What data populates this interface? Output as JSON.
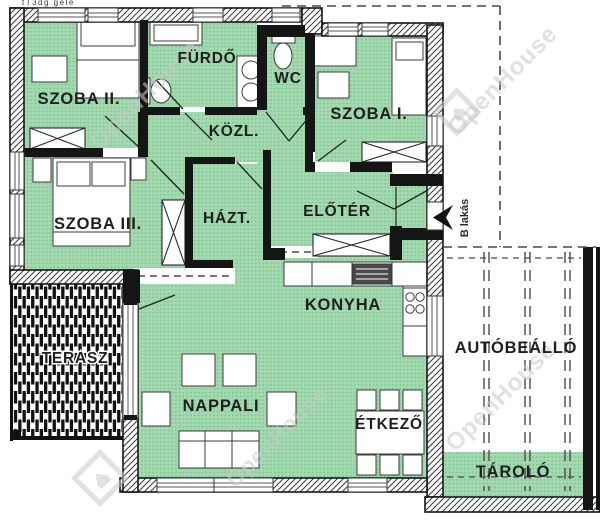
{
  "rooms": {
    "szoba2": "SZOBA II.",
    "furdo": "FÜRDŐ",
    "wc": "WC",
    "szoba1": "SZOBA I.",
    "kozl": "KÖZL.",
    "szoba3": "SZOBA III.",
    "hazt": "HÁZT.",
    "eloter": "ELŐTÉR",
    "konyha": "KONYHA",
    "terasz": "TERASZ",
    "nappali": "NAPPALI",
    "etkezo": "ÉTKEZŐ",
    "autobeallo": "AUTÓBEÁLLÓ",
    "tarolo": "TÁROLÓ"
  },
  "annotations": {
    "b_lakas": "B lakás",
    "corner_fragment": "tT3dg gele"
  },
  "watermark": {
    "text": "OpenHouse"
  },
  "colors": {
    "room_fill": "#a4d9b0",
    "room_dot": "#6fbe8b",
    "wall": "#151515",
    "hatch_line": "#3a3a3a",
    "dash_line": "#4a4a4a",
    "label": "#1f1f1f",
    "watermark": "#c7ccc8"
  }
}
